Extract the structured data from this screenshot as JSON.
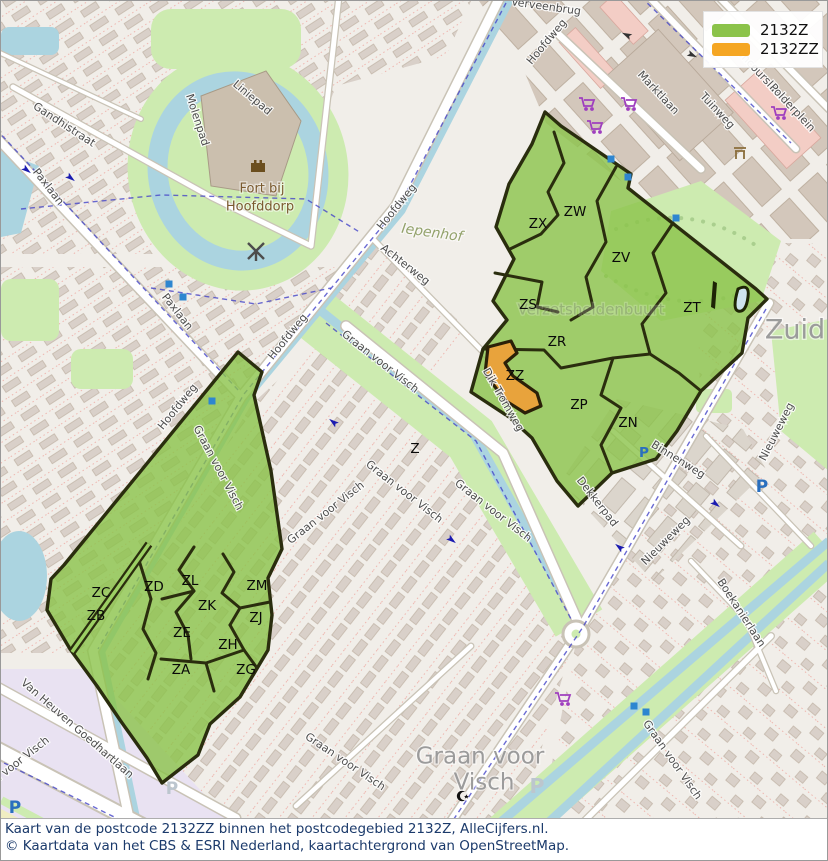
{
  "legend": {
    "items": [
      {
        "label": "2132Z",
        "color": "#8bc34a"
      },
      {
        "label": "2132ZZ",
        "color": "#f5a623"
      }
    ]
  },
  "caption": {
    "line1": "Kaart van de postcode 2132ZZ binnen het postcodegebied 2132Z, AlleCijfers.nl.",
    "line2": "© Kaartdata van het CBS & ESRI Nederland, kaartachtergrond van OpenStreetMap."
  },
  "colors": {
    "postcode_area_fill": "#8bc34a",
    "postcode_zz_fill": "#e8a33c",
    "boundary_stroke": "#2a2d0e",
    "water": "#abd4e0",
    "park": "#cdebb0",
    "caption_text": "#1b3a6b"
  },
  "area_labels": [
    {
      "code": "ZX",
      "x": 537,
      "y": 223
    },
    {
      "code": "ZW",
      "x": 574,
      "y": 211
    },
    {
      "code": "ZV",
      "x": 620,
      "y": 257
    },
    {
      "code": "ZS",
      "x": 527,
      "y": 304
    },
    {
      "code": "ZT",
      "x": 691,
      "y": 307
    },
    {
      "code": "ZR",
      "x": 556,
      "y": 341
    },
    {
      "code": "ZZ",
      "x": 514,
      "y": 375
    },
    {
      "code": "ZP",
      "x": 578,
      "y": 404
    },
    {
      "code": "ZN",
      "x": 627,
      "y": 422
    },
    {
      "code": "Z",
      "x": 414,
      "y": 448,
      "size": 12.5
    },
    {
      "code": "ZC",
      "x": 100,
      "y": 592
    },
    {
      "code": "ZB",
      "x": 95,
      "y": 615
    },
    {
      "code": "ZD",
      "x": 153,
      "y": 586
    },
    {
      "code": "ZL",
      "x": 189,
      "y": 580
    },
    {
      "code": "ZM",
      "x": 256,
      "y": 585
    },
    {
      "code": "ZK",
      "x": 206,
      "y": 605
    },
    {
      "code": "ZJ",
      "x": 255,
      "y": 617
    },
    {
      "code": "ZE",
      "x": 181,
      "y": 632
    },
    {
      "code": "ZH",
      "x": 227,
      "y": 644
    },
    {
      "code": "ZA",
      "x": 180,
      "y": 669
    },
    {
      "code": "ZG",
      "x": 245,
      "y": 669
    }
  ],
  "street_labels": [
    {
      "name": "Gandhistraat",
      "x": 63,
      "y": 124,
      "r": 33
    },
    {
      "name": "Paxlaan",
      "x": 47,
      "y": 186,
      "r": 52
    },
    {
      "name": "Paxlaan",
      "x": 176,
      "y": 311,
      "r": 52
    },
    {
      "name": "Molenpad",
      "x": 196,
      "y": 119,
      "r": 72
    },
    {
      "name": "Liniepad",
      "x": 251,
      "y": 97,
      "r": 40
    },
    {
      "name": "Verveenbrug",
      "x": 545,
      "y": 6,
      "r": 8,
      "size": 10.5
    },
    {
      "name": "Hoofdweg",
      "x": 546,
      "y": 41,
      "r": -50
    },
    {
      "name": "Hoofdweg",
      "x": 396,
      "y": 206,
      "r": -51
    },
    {
      "name": "Hoofdweg",
      "x": 287,
      "y": 336,
      "r": -51
    },
    {
      "name": "Hoofdweg",
      "x": 177,
      "y": 406,
      "r": -51
    },
    {
      "name": "Achterweg",
      "x": 404,
      "y": 264,
      "r": 38
    },
    {
      "name": "Marktlaan",
      "x": 657,
      "y": 92,
      "r": 47
    },
    {
      "name": "Tuinweg",
      "x": 716,
      "y": 110,
      "r": 47
    },
    {
      "name": "Concourslaan",
      "x": 758,
      "y": 72,
      "r": 47
    },
    {
      "name": "Polderplein",
      "x": 791,
      "y": 107,
      "r": 47
    },
    {
      "name": "Dik Tromweg",
      "x": 502,
      "y": 399,
      "r": 60
    },
    {
      "name": "Binnenweg",
      "x": 677,
      "y": 459,
      "r": 32
    },
    {
      "name": "Dekkerpad",
      "x": 596,
      "y": 501,
      "r": 52
    },
    {
      "name": "Nieuweweg",
      "x": 776,
      "y": 431,
      "r": -63
    },
    {
      "name": "Nieuweweg",
      "x": 665,
      "y": 540,
      "r": -45
    },
    {
      "name": "Boekanierlaan",
      "x": 740,
      "y": 612,
      "r": 57
    },
    {
      "name": "Graan voor Visch",
      "x": 379,
      "y": 361,
      "r": 38
    },
    {
      "name": "Graan voor Visch",
      "x": 403,
      "y": 491,
      "r": 38
    },
    {
      "name": "Graan voor Visch",
      "x": 492,
      "y": 510,
      "r": 38
    },
    {
      "name": "Graan voor Visch",
      "x": 325,
      "y": 512,
      "r": -38
    },
    {
      "name": "Graan voor Visch",
      "x": 217,
      "y": 467,
      "r": 62
    },
    {
      "name": "Graan voor Visch",
      "x": 344,
      "y": 761,
      "r": 34
    },
    {
      "name": "Graan voor Visch",
      "x": 671,
      "y": 759,
      "r": 55
    },
    {
      "name": "Graan voor Visch",
      "x": 10,
      "y": 767,
      "r": -38
    },
    {
      "name": "Van Heuven Goedhartlaan",
      "x": 76,
      "y": 728,
      "r": 41
    }
  ],
  "place_labels": [
    {
      "name": "Fort bij",
      "x": 261,
      "y": 188,
      "size": 13,
      "color": "#7b5b30"
    },
    {
      "name": "Hoofddorp",
      "x": 259,
      "y": 206,
      "size": 13,
      "color": "#7b5b30"
    },
    {
      "name": "Iepenhof",
      "x": 431,
      "y": 232,
      "size": 14,
      "color": "#93a26b",
      "italic": true,
      "r": 8
    },
    {
      "name": "Zuid",
      "x": 794,
      "y": 330,
      "size": 27,
      "color": "#9b9b9b"
    },
    {
      "name": "Graan voor",
      "x": 479,
      "y": 756,
      "size": 23,
      "color": "#9b9b9b"
    },
    {
      "name": "Visch",
      "x": 483,
      "y": 782,
      "size": 23,
      "color": "#9b9b9b"
    },
    {
      "name": "Verzetsheldenbuurt",
      "x": 590,
      "y": 309,
      "size": 15,
      "color": "#8a8a8a",
      "opacity": 0.38
    }
  ],
  "icons": [
    {
      "type": "cart",
      "name": "shopping-cart-icon",
      "x": 585,
      "y": 103
    },
    {
      "type": "cart",
      "name": "shopping-cart-icon",
      "x": 627,
      "y": 103
    },
    {
      "type": "cart",
      "name": "shopping-cart-icon",
      "x": 593,
      "y": 126
    },
    {
      "type": "cart",
      "name": "shopping-cart-icon",
      "x": 561,
      "y": 698
    },
    {
      "type": "cart",
      "name": "shopping-cart-icon",
      "x": 777,
      "y": 112
    },
    {
      "type": "parking",
      "name": "parking-icon",
      "x": 643,
      "y": 452,
      "scale": 0.8
    },
    {
      "type": "parking",
      "name": "parking-icon",
      "x": 761,
      "y": 486
    },
    {
      "type": "parking",
      "name": "parking-icon",
      "x": 14,
      "y": 807
    },
    {
      "type": "parking-faint",
      "name": "parking-icon-faint",
      "x": 536,
      "y": 786,
      "scale": 1.2
    },
    {
      "type": "parking-faint",
      "name": "parking-icon-faint",
      "x": 171,
      "y": 788
    },
    {
      "type": "stop",
      "name": "transit-stop-icon",
      "x": 610,
      "y": 158
    },
    {
      "type": "stop",
      "name": "transit-stop-icon",
      "x": 627,
      "y": 176
    },
    {
      "type": "stop",
      "name": "transit-stop-icon",
      "x": 675,
      "y": 217
    },
    {
      "type": "stop",
      "name": "transit-stop-icon",
      "x": 168,
      "y": 283
    },
    {
      "type": "stop",
      "name": "transit-stop-icon",
      "x": 182,
      "y": 296
    },
    {
      "type": "stop",
      "name": "transit-stop-icon",
      "x": 211,
      "y": 400
    },
    {
      "type": "stop",
      "name": "transit-stop-icon",
      "x": 633,
      "y": 705
    },
    {
      "type": "stop",
      "name": "transit-stop-icon",
      "x": 645,
      "y": 711
    },
    {
      "type": "castle",
      "name": "fort-castle-icon",
      "x": 257,
      "y": 165
    },
    {
      "type": "windmill",
      "name": "windmill-icon",
      "x": 255,
      "y": 250
    },
    {
      "type": "mosque",
      "name": "mosque-crescent-icon",
      "x": 461,
      "y": 795
    },
    {
      "type": "shrine",
      "name": "monument-icon",
      "x": 739,
      "y": 152
    },
    {
      "type": "arrow",
      "name": "oneway-arrow-icon",
      "x": 22,
      "y": 166,
      "r": 38
    },
    {
      "type": "arrow",
      "name": "oneway-arrow-icon",
      "x": 66,
      "y": 174,
      "r": 38
    },
    {
      "type": "arrow",
      "name": "oneway-arrow-icon",
      "x": 336,
      "y": 424,
      "r": 218
    },
    {
      "type": "arrow",
      "name": "oneway-arrow-icon",
      "x": 447,
      "y": 536,
      "r": 38
    },
    {
      "type": "arrow",
      "name": "oneway-arrow-icon",
      "x": 622,
      "y": 549,
      "r": 218
    },
    {
      "type": "arrow",
      "name": "oneway-arrow-icon",
      "x": 711,
      "y": 500,
      "r": 38
    },
    {
      "type": "arrow-black",
      "name": "oneway-arrow-icon",
      "x": 630,
      "y": 36,
      "r": 205
    },
    {
      "type": "arrow-black",
      "name": "oneway-arrow-icon",
      "x": 687,
      "y": 52,
      "r": 25
    }
  ]
}
